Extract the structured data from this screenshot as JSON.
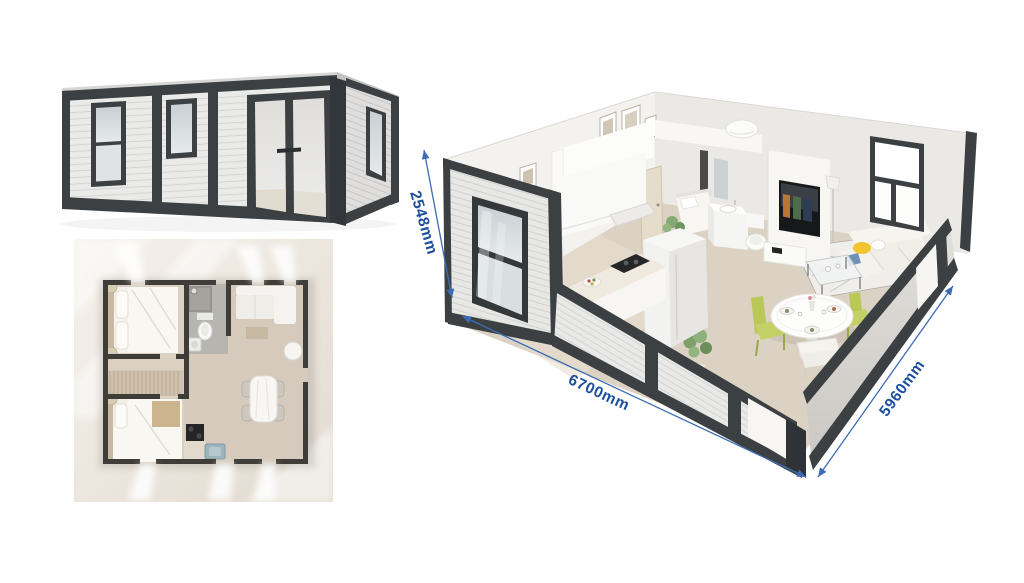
{
  "dimensions": {
    "height": {
      "label": "2548mm"
    },
    "length": {
      "label": "6700mm"
    },
    "width": {
      "label": "5960mm"
    }
  },
  "colors": {
    "dimension_text": "#1d4f9f",
    "dimension_line": "#3c6cb4",
    "frame_dark": "#3c4043",
    "siding_light": "#eaeae8",
    "interior_wall": "#f3f2ef",
    "floor_beige": "#dbd2c3",
    "plan_wall": "#403c37",
    "plan_floor": "#d5cabc",
    "chair_green": "#bcca62",
    "accent_yellow": "#f2c52e"
  }
}
